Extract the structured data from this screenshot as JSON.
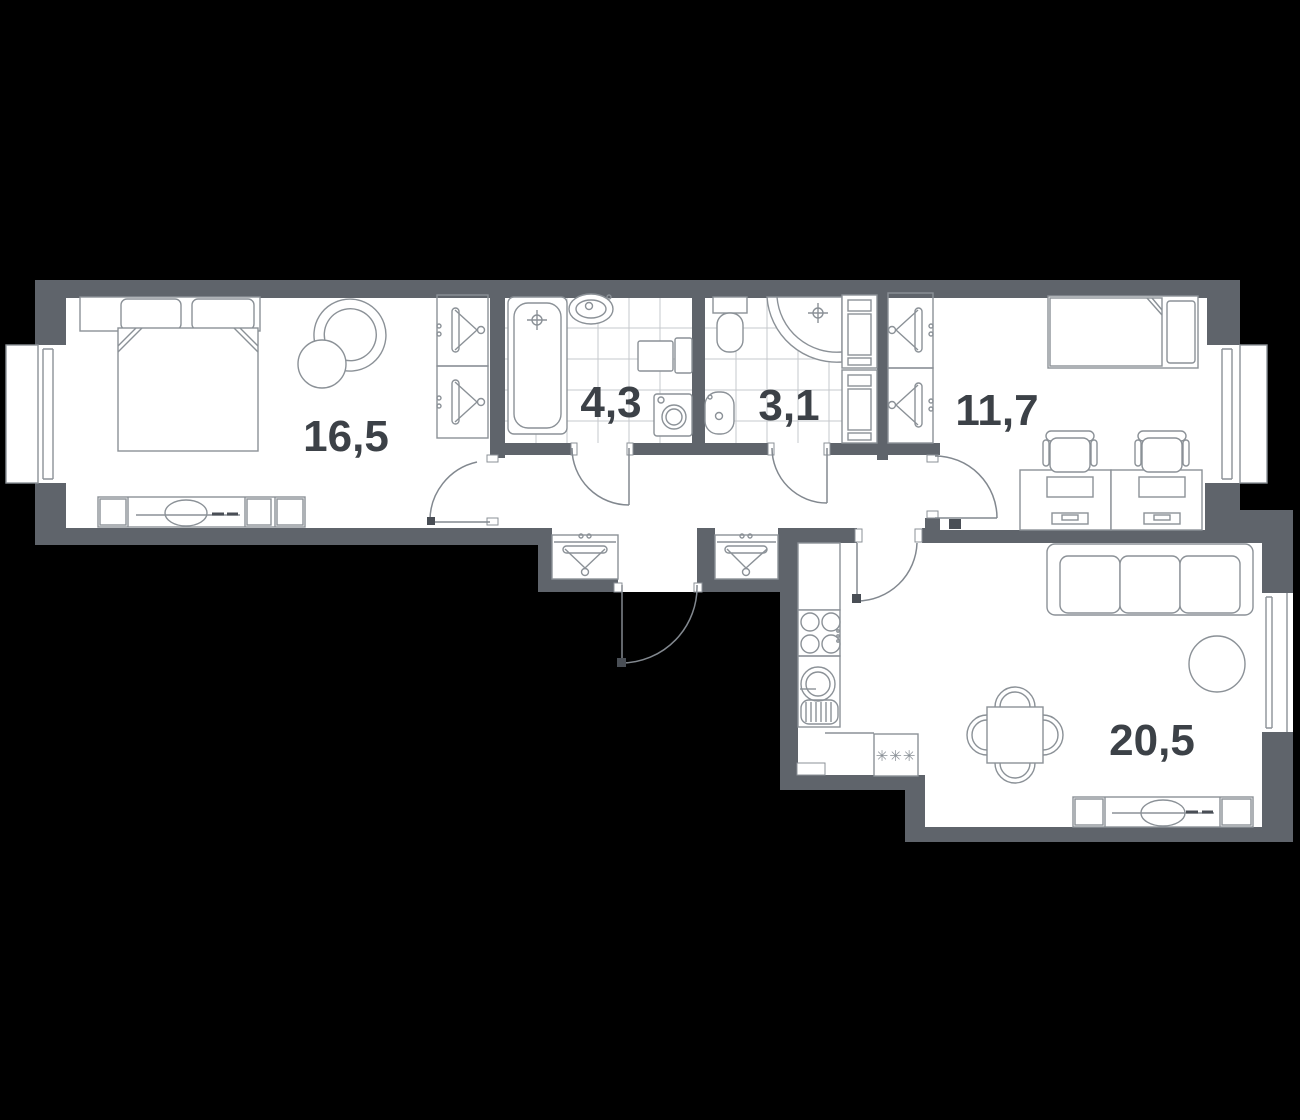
{
  "plan": {
    "title": "apartment-floor-plan",
    "rooms": [
      {
        "id": "bedroom",
        "area": "16,5"
      },
      {
        "id": "bathroom",
        "area": "4,3"
      },
      {
        "id": "toilet",
        "area": "3,1"
      },
      {
        "id": "bedroom-2",
        "area": "11,7"
      },
      {
        "id": "kitchen-living",
        "area": "20,5"
      }
    ],
    "kitchen_marker": "✳✳✳",
    "colors": {
      "background": "#000000",
      "wall": "#5f646b",
      "floor": "#ffffff",
      "furniture_line": "#8b9197",
      "tile_line": "#c6c9cc",
      "door_line": "#82888f",
      "label_text": "#3c4147",
      "dark_mark": "#494e55"
    }
  }
}
